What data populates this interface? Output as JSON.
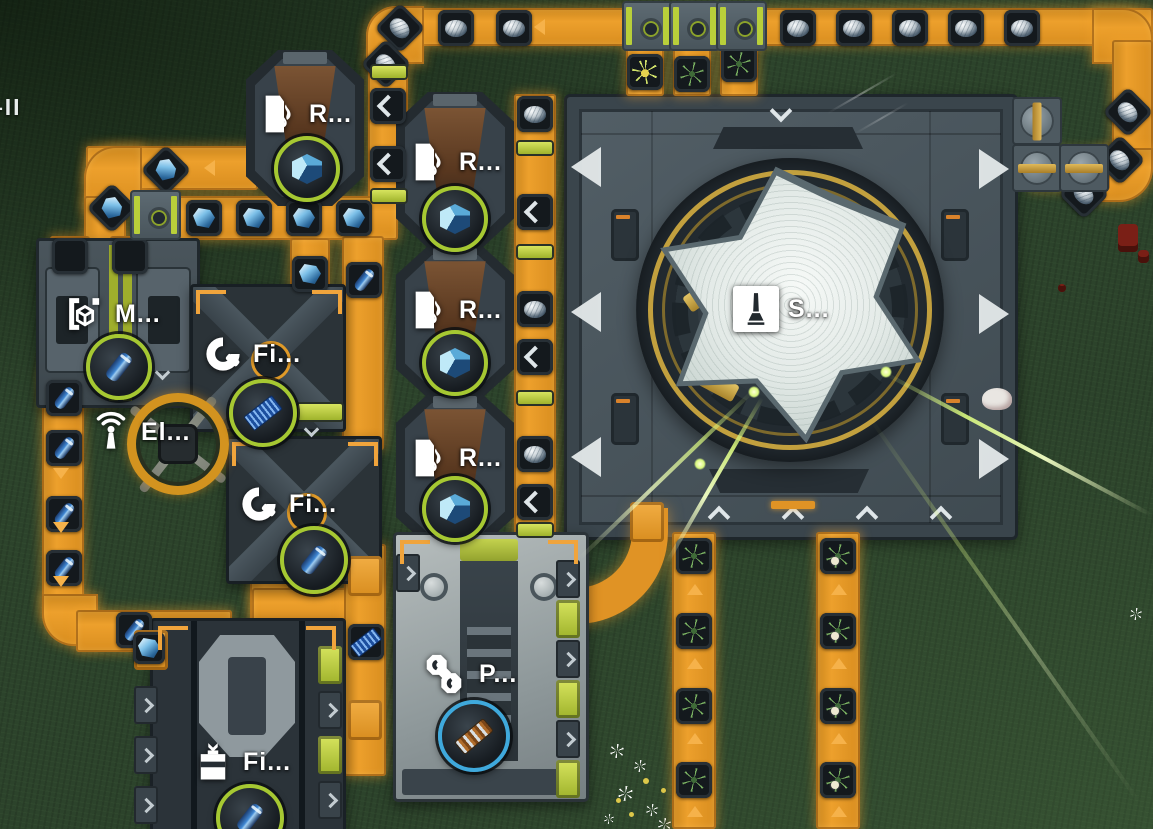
{
  "hud": {
    "edge_label": "–II"
  },
  "machines": [
    {
      "id": "refinery-1",
      "label": "R...",
      "icon": "flame-sheet-icon",
      "output_item": "blue-ore-cube",
      "ring": "lime"
    },
    {
      "id": "refinery-2",
      "label": "R...",
      "icon": "flame-sheet-icon",
      "output_item": "blue-ore-cube",
      "ring": "lime"
    },
    {
      "id": "refinery-3",
      "label": "R...",
      "icon": "flame-sheet-icon",
      "output_item": "blue-ore-cube",
      "ring": "lime"
    },
    {
      "id": "refinery-4",
      "label": "R...",
      "icon": "flame-sheet-icon",
      "output_item": "blue-ore-cube",
      "ring": "lime"
    },
    {
      "id": "molder",
      "label": "M...",
      "icon": "cube-brackets-icon",
      "output_item": "blue-capsule",
      "ring": "lime"
    },
    {
      "id": "fitter-1",
      "label": "Fi...",
      "icon": "c-wrench-icon",
      "output_item": "blue-circuit-board",
      "ring": "lime"
    },
    {
      "id": "fitter-2",
      "label": "Fi...",
      "icon": "c-wrench-icon",
      "output_item": "blue-capsule",
      "ring": "lime"
    },
    {
      "id": "electric-pole",
      "label": "El...",
      "icon": "antenna-waves-icon",
      "output_item": null,
      "ring": null
    },
    {
      "id": "shield-structure",
      "label": "S...",
      "icon": "obelisk-icon",
      "output_item": null,
      "ring": null
    },
    {
      "id": "press",
      "label": "P...",
      "icon": "linked-joints-icon",
      "output_item": "copper-rail-bundle",
      "ring": "blue"
    },
    {
      "id": "filler",
      "label": "Fi...",
      "icon": "container-box-icon",
      "output_item": "blue-capsule-rising",
      "ring": "lime"
    }
  ],
  "belt_items": [
    "silver-ore-nugget",
    "blue-crystal-chunk",
    "blue-capsule",
    "blue-circuit-board",
    "green-herb-plant",
    "white-bulb-herb",
    "yellow-flower-bunch"
  ],
  "colors": {
    "belt": "#e8971f",
    "belt_glow": "#ffb347",
    "accent_lime": "#b9cf3a",
    "ring_lime": "#a6c832",
    "ring_blue": "#3fa9dc",
    "laser": "#d9f87e",
    "platform": "#4a575f",
    "dome": "#e9efec",
    "grass": "#2b422a"
  },
  "world": {
    "entities": [
      "red-robot-figure",
      "white-creature",
      "wild-flowers"
    ]
  }
}
